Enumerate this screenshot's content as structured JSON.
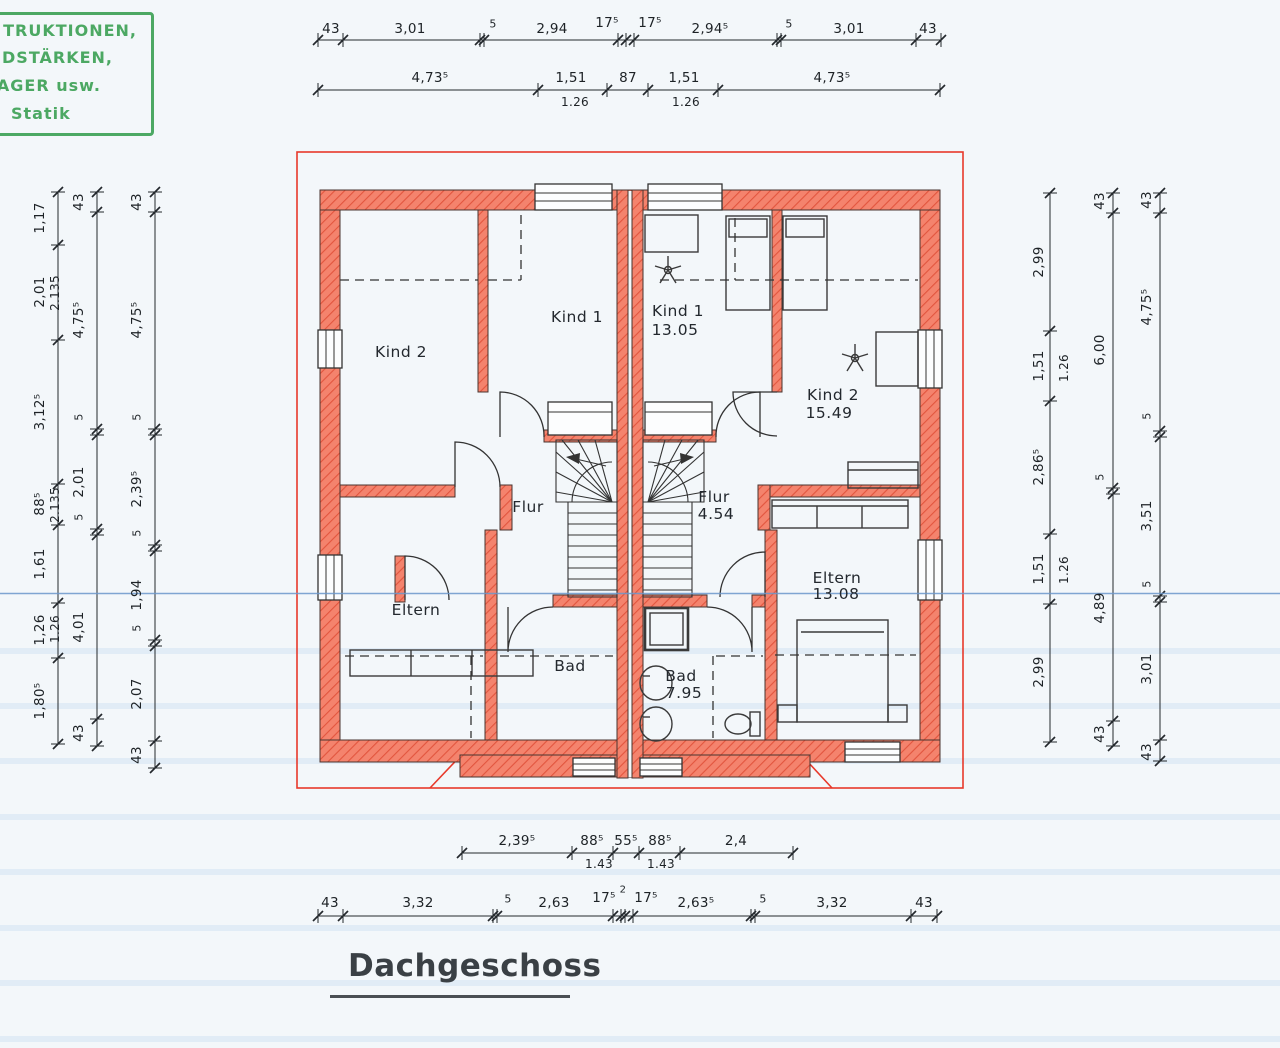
{
  "title": {
    "text": "Dachgeschoss"
  },
  "stamp": {
    "lines": [
      "TRUKTIONEN,",
      "DSTÄRKEN,",
      "AGER usw.",
      "Statik"
    ]
  },
  "rooms": {
    "kind2_left": {
      "name": "Kind 2"
    },
    "kind1_left": {
      "name": "Kind 1"
    },
    "kind1_right": {
      "name": "Kind 1",
      "area": "13.05"
    },
    "kind2_right": {
      "name": "Kind 2",
      "area": "15.49"
    },
    "flur_left": {
      "name": "Flur"
    },
    "flur_right": {
      "name": "Flur",
      "area": "4.54"
    },
    "eltern_left": {
      "name": "Eltern"
    },
    "bad_left": {
      "name": "Bad"
    },
    "bad_right": {
      "name": "Bad",
      "area": "7.95"
    },
    "eltern_right": {
      "name": "Eltern",
      "area": "13.08"
    }
  },
  "dims": {
    "top_1": [
      "43",
      "3,01",
      "5",
      "2,94",
      "17⁵",
      "17⁵",
      "2,94⁵",
      "5",
      "3,01",
      "43"
    ],
    "top_2": [
      "4,73⁵",
      "1,51",
      "87",
      "1,51",
      "4,73⁵"
    ],
    "top_2_sub": [
      "1.26",
      "1.26"
    ],
    "bottom_1": [
      "2,39⁵",
      "88⁵",
      "55⁵",
      "88⁵",
      "2,4"
    ],
    "bottom_1_sub": [
      "1.43",
      "1.43"
    ],
    "bottom_2": [
      "43",
      "3,32",
      "5",
      "2,63",
      "17⁵",
      "17⁵",
      "2,63⁵",
      "5",
      "3,32",
      "43"
    ],
    "bottom_2_gap": "2",
    "left_1": [
      "1,17",
      "2,01",
      "3,12⁵",
      "88⁵",
      "1,61",
      "1,26",
      "1,80⁵"
    ],
    "left_1_sub": [
      "2.135",
      "2.135",
      "1.26"
    ],
    "left_2": [
      "43",
      "4,75⁵",
      "5",
      "2,01",
      "5",
      "4,01",
      "43"
    ],
    "left_3": [
      "43",
      "4,75⁵",
      "5",
      "2,39⁵",
      "5",
      "1,94",
      "5",
      "2,07",
      "43"
    ],
    "right_1": [
      "2,99",
      "1,51",
      "2,86⁵",
      "1,51",
      "2,99"
    ],
    "right_1_sub": [
      "1.26",
      "1.26"
    ],
    "right_2": [
      "43",
      "6,00",
      "5",
      "4,89",
      "43"
    ],
    "right_3": [
      "43",
      "4,75⁵",
      "5",
      "3,51",
      "5",
      "3,01",
      "43"
    ]
  },
  "colors": {
    "paper": "#f3f7fa",
    "wall_fill": "#f4836d",
    "wall_hatch": "#e2553e",
    "eave_red": "#e8392b",
    "stamp_green": "#3aa053",
    "scan_line": "#6b97cc",
    "scan_band": "#cfe2f2",
    "ink": "#23282c"
  }
}
